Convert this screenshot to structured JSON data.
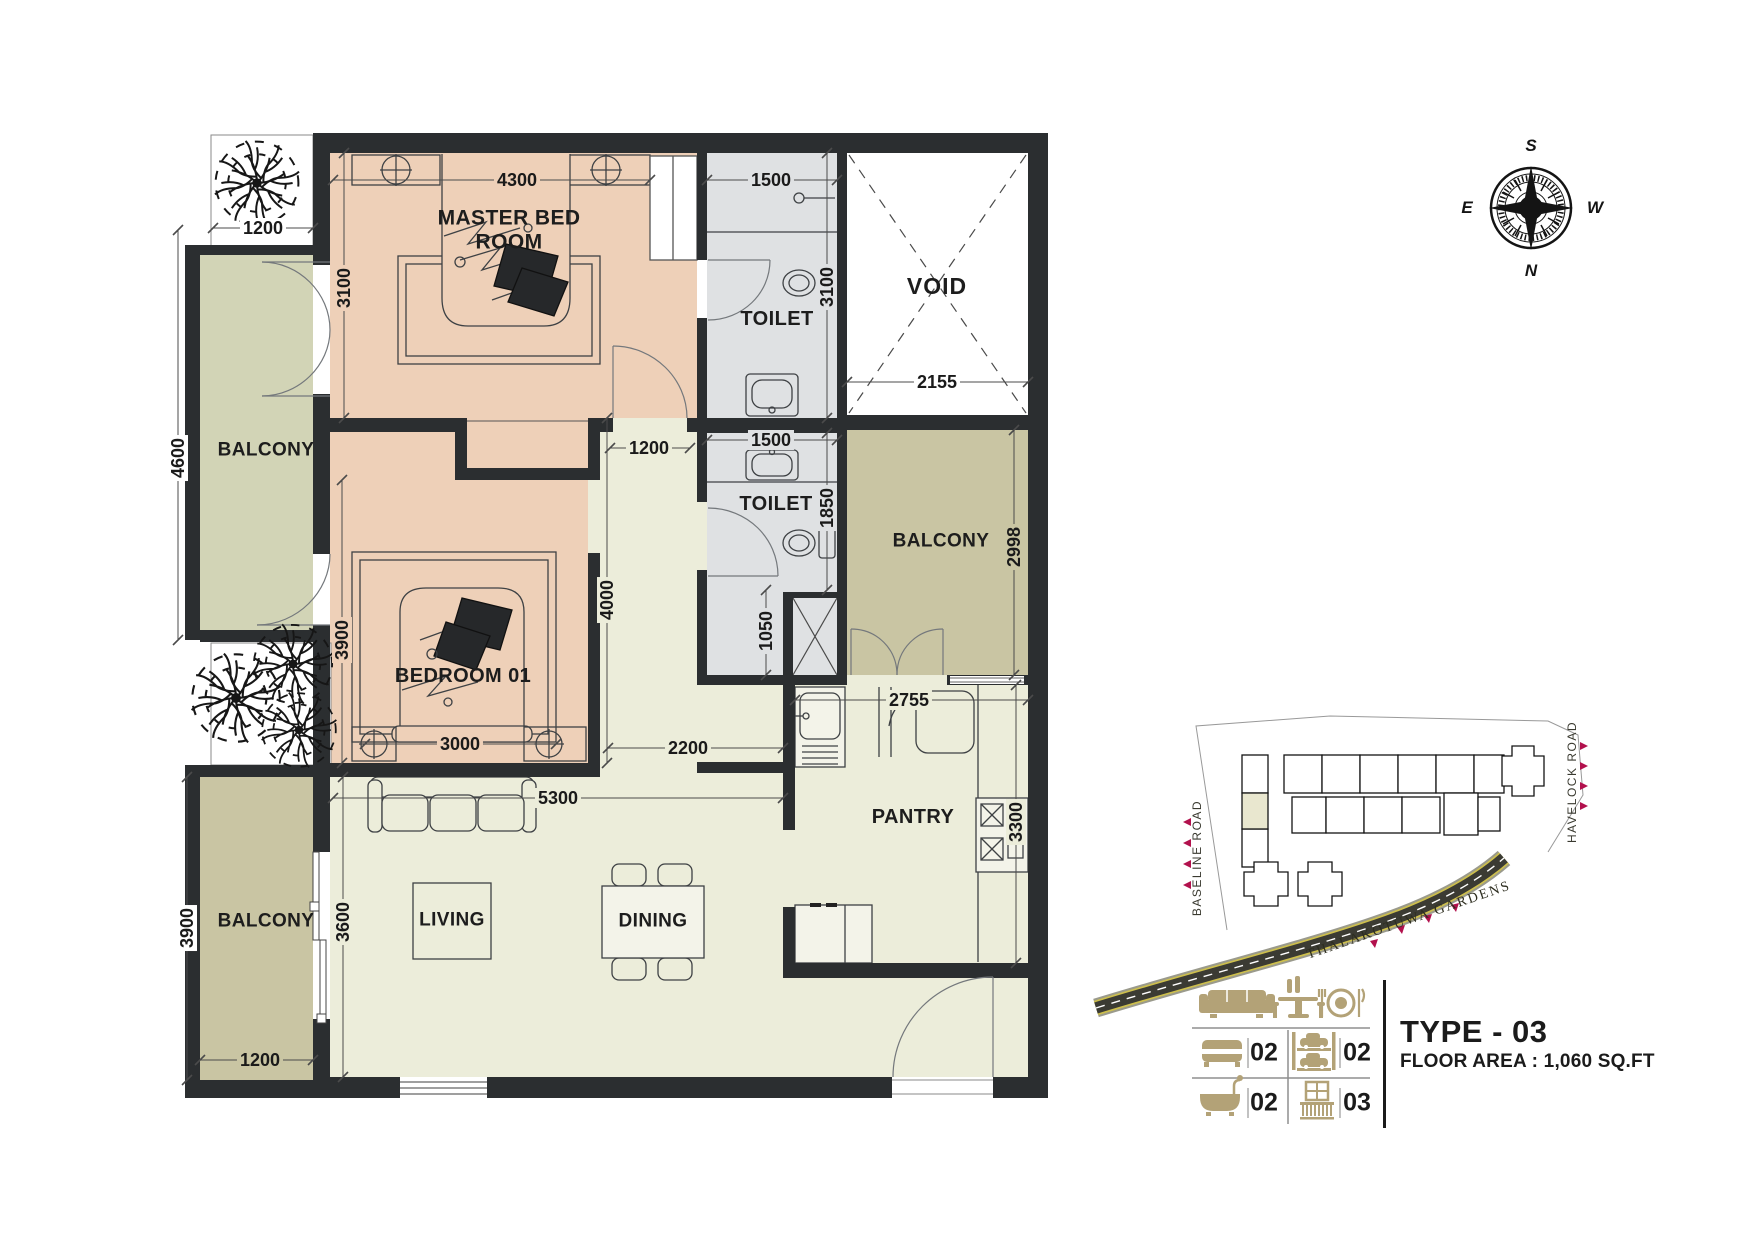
{
  "plan": {
    "rooms": [
      {
        "id": "master-bedroom",
        "label": "MASTER BED ROOM",
        "x": 509,
        "y": 230,
        "w": 160,
        "size": 21
      },
      {
        "id": "toilet-1",
        "label": "TOILET",
        "x": 777,
        "y": 319,
        "w": 130,
        "size": 20
      },
      {
        "id": "void",
        "label": "VOID",
        "x": 937,
        "y": 287,
        "w": 110,
        "size": 23
      },
      {
        "id": "toilet-2",
        "label": "TOILET",
        "x": 776,
        "y": 504,
        "w": 130,
        "size": 20
      },
      {
        "id": "balcony-right",
        "label": "BALCONY",
        "x": 941,
        "y": 541,
        "w": 130,
        "size": 19
      },
      {
        "id": "balcony-upper-left",
        "label": "BALCONY",
        "x": 266,
        "y": 450,
        "w": 130,
        "size": 19
      },
      {
        "id": "bedroom-01",
        "label": "BEDROOM 01",
        "x": 463,
        "y": 676,
        "w": 170,
        "size": 20
      },
      {
        "id": "living",
        "label": "LIVING",
        "x": 452,
        "y": 920,
        "w": 110,
        "size": 19
      },
      {
        "id": "dining",
        "label": "DINING",
        "x": 653,
        "y": 921,
        "w": 110,
        "size": 19
      },
      {
        "id": "pantry",
        "label": "PANTRY",
        "x": 913,
        "y": 817,
        "w": 120,
        "size": 20
      },
      {
        "id": "balcony-lower-left",
        "label": "BALCONY",
        "x": 266,
        "y": 921,
        "w": 130,
        "size": 19
      }
    ],
    "dimensions": [
      {
        "label": "4300",
        "x1": 333,
        "y1": 180,
        "x2": 650,
        "y2": 180,
        "lx": 517,
        "ly": 180,
        "rot": 0,
        "bg": "bedroom"
      },
      {
        "label": "1500",
        "x1": 707,
        "y1": 180,
        "x2": 837,
        "y2": 180,
        "lx": 771,
        "ly": 180,
        "rot": 0,
        "bg": "toilet"
      },
      {
        "label": "1200",
        "x1": 213,
        "y1": 228,
        "x2": 313,
        "y2": 228,
        "lx": 263,
        "ly": 228,
        "rot": 0,
        "bg": "white"
      },
      {
        "label": "2155",
        "x1": 847,
        "y1": 382,
        "x2": 1028,
        "y2": 382,
        "lx": 937,
        "ly": 382,
        "rot": 0,
        "bg": "white"
      },
      {
        "label": "1200",
        "x1": 610,
        "y1": 448,
        "x2": 690,
        "y2": 448,
        "lx": 649,
        "ly": 448,
        "rot": 0,
        "bg": "living"
      },
      {
        "label": "1500",
        "x1": 707,
        "y1": 440,
        "x2": 837,
        "y2": 440,
        "lx": 771,
        "ly": 440,
        "rot": 0,
        "bg": "toilet"
      },
      {
        "label": "3000",
        "x1": 365,
        "y1": 744,
        "x2": 556,
        "y2": 744,
        "lx": 460,
        "ly": 744,
        "rot": 0,
        "bg": "bedroom"
      },
      {
        "label": "5300",
        "x1": 333,
        "y1": 798,
        "x2": 783,
        "y2": 798,
        "lx": 558,
        "ly": 798,
        "rot": 0,
        "bg": "living"
      },
      {
        "label": "2200",
        "x1": 608,
        "y1": 748,
        "x2": 783,
        "y2": 748,
        "lx": 688,
        "ly": 748,
        "rot": 0,
        "bg": "living"
      },
      {
        "label": "2755",
        "x1": 795,
        "y1": 700,
        "x2": 1028,
        "y2": 700,
        "lx": 909,
        "ly": 700,
        "rot": 0,
        "bg": "living"
      },
      {
        "label": "1200",
        "x1": 200,
        "y1": 1060,
        "x2": 313,
        "y2": 1060,
        "lx": 260,
        "ly": 1060,
        "rot": 0,
        "bg": "balcony"
      },
      {
        "label": "3100",
        "x1": 344,
        "y1": 153,
        "x2": 344,
        "y2": 418,
        "lx": 344,
        "ly": 288,
        "rot": 1,
        "bg": "bedroom"
      },
      {
        "label": "4600",
        "x1": 178,
        "y1": 230,
        "x2": 178,
        "y2": 640,
        "lx": 178,
        "ly": 458,
        "rot": 1,
        "bg": "white"
      },
      {
        "label": "3900",
        "x1": 342,
        "y1": 480,
        "x2": 342,
        "y2": 763,
        "lx": 342,
        "ly": 640,
        "rot": 1,
        "bg": "bedroom"
      },
      {
        "label": "4000",
        "x1": 607,
        "y1": 418,
        "x2": 607,
        "y2": 763,
        "lx": 607,
        "ly": 600,
        "rot": 1,
        "bg": "living"
      },
      {
        "label": "3100",
        "x1": 827,
        "y1": 153,
        "x2": 827,
        "y2": 418,
        "lx": 827,
        "ly": 287,
        "rot": 1,
        "bg": "toilet"
      },
      {
        "label": "1850",
        "x1": 827,
        "y1": 433,
        "x2": 827,
        "y2": 590,
        "lx": 827,
        "ly": 508,
        "rot": 1,
        "bg": "toilet"
      },
      {
        "label": "2998",
        "x1": 1014,
        "y1": 430,
        "x2": 1014,
        "y2": 675,
        "lx": 1014,
        "ly": 547,
        "rot": 1,
        "bg": "balcony"
      },
      {
        "label": "1050",
        "x1": 766,
        "y1": 590,
        "x2": 766,
        "y2": 675,
        "lx": 766,
        "ly": 631,
        "rot": 1,
        "bg": "toilet"
      },
      {
        "label": "3300",
        "x1": 1016,
        "y1": 685,
        "x2": 1016,
        "y2": 963,
        "lx": 1016,
        "ly": 822,
        "rot": 1,
        "bg": "living"
      },
      {
        "label": "3900",
        "x1": 187,
        "y1": 777,
        "x2": 187,
        "y2": 1080,
        "lx": 187,
        "ly": 928,
        "rot": 1,
        "bg": "white"
      },
      {
        "label": "3600",
        "x1": 343,
        "y1": 777,
        "x2": 343,
        "y2": 1077,
        "lx": 343,
        "ly": 922,
        "rot": 1,
        "bg": "living"
      }
    ]
  },
  "compass": {
    "north": "N",
    "south": "S",
    "east": "E",
    "west": "W"
  },
  "site_plan": {
    "road_left": "BASELINE ROAD",
    "road_right": "HAVELOCK ROAD",
    "road_bottom": "THALAKOTUWA GARDENS"
  },
  "legend": {
    "top_icons": [
      "sofa-icon",
      "bar-table-icon",
      "dining-plate-icon"
    ],
    "counts": [
      {
        "icon": "bed-icon",
        "value": "02"
      },
      {
        "icon": "car-parking-icon",
        "value": "02"
      },
      {
        "icon": "bathtub-icon",
        "value": "02"
      },
      {
        "icon": "balcony-icon",
        "value": "03"
      }
    ]
  },
  "title_block": {
    "type_label": "TYPE - 03",
    "floor_area_label": "FLOOR AREA : 1,060 SQ.FT"
  },
  "colors": {
    "bedroom": "#eed0b8",
    "living": "#ecedda",
    "toilet": "#dfe1e3",
    "balcony": "#c9c5a3",
    "balcony_light": "#d2d4b6",
    "white": "#ffffff",
    "wall": "#2b2e30",
    "accent_red": "#b2114d",
    "legend_tan": "#b3a277",
    "road_dark": "#3b3b33",
    "road_yellow": "#cdbf4e"
  }
}
